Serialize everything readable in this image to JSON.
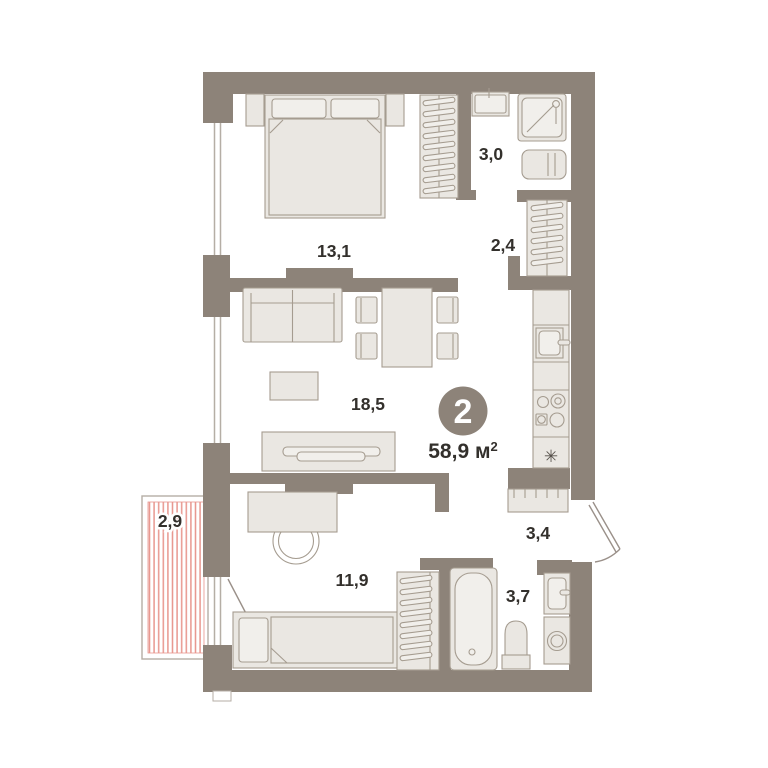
{
  "floor_plan": {
    "badge": {
      "rooms_count": "2"
    },
    "total_area": {
      "value": "58,9 м",
      "superscript": "2"
    },
    "room_labels": {
      "bedroom_main": "13,1",
      "shower_room": "3,0",
      "wardrobe_room": "2,4",
      "living_room": "18,5",
      "balcony": "2,9",
      "bedroom_second": "11,9",
      "hallway": "3,4",
      "bathroom": "3,7"
    },
    "icons": {
      "fridge_snowflake": "✳"
    },
    "colors": {
      "wall": "#8d8379",
      "furniture_fill": "#eae7e2",
      "furniture_stroke": "#a59c90",
      "balcony_hatch": "#e8968e",
      "window_line": "#b5aea5",
      "text": "#33302c"
    }
  }
}
